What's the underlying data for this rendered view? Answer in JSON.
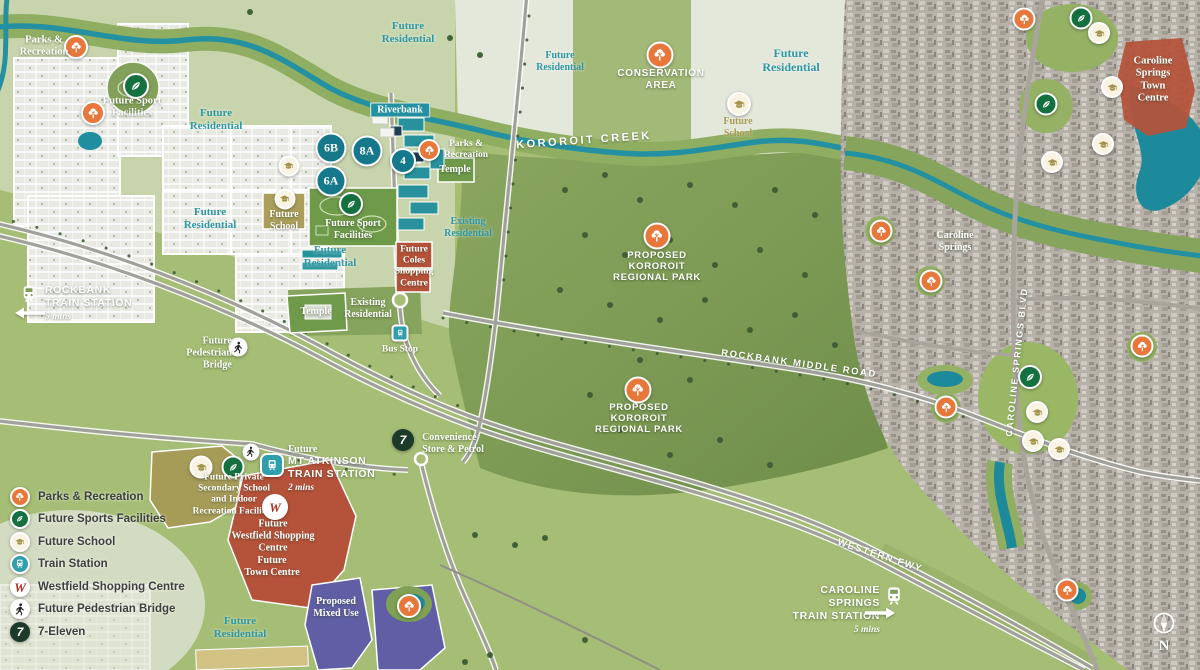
{
  "legend": {
    "items": [
      {
        "icon": "tree-icon",
        "label": "Parks & Recreation"
      },
      {
        "icon": "leaf-icon",
        "label": "Future Sports Facilities"
      },
      {
        "icon": "school-icon",
        "label": "Future School"
      },
      {
        "icon": "train-icon",
        "label": "Train Station"
      },
      {
        "icon": "westfield-icon",
        "label": "Westfield Shopping Centre"
      },
      {
        "icon": "pedestrian-icon",
        "label": "Future Pedestrian Bridge"
      },
      {
        "icon": "seven-eleven-icon",
        "label": "7-Eleven"
      }
    ]
  },
  "labels": {
    "future_residential": "Future\nResidential",
    "existing_residential": "Existing\nResidential",
    "parks_recreation": "Parks &\nRecreation",
    "future_sport_facilities": "Future Sport\nFacilities",
    "riverbank": "Riverbank",
    "temple": "Temple",
    "future_school": "Future\nSchool",
    "future_coles": "Future\nColes\nShopping\nCentre",
    "bus_stop": "Bus Stop",
    "future_pedestrian_bridge": "Future\nPedestrian\nBridge",
    "conservation_area": "CONSERVATION\nAREA",
    "kororoit_creek": "KOROROIT CREEK",
    "proposed_kororoit_regional_park": "PROPOSED\nKOROROIT\nREGIONAL PARK",
    "rockbank_middle_road": "ROCKBANK MIDDLE ROAD",
    "western_fwy": "WESTERN FWY",
    "caroline_springs_blvd": "CAROLINE SPRINGS BLVD",
    "caroline_springs": "Caroline\nSprings",
    "caroline_springs_town_centre": "Caroline\nSprings Town\nCentre",
    "proposed_mixed_use": "Proposed\nMixed Use",
    "future_town_centre": "Future\nTown Centre",
    "future_westfield_shopping_centre": "Future\nWestfield Shopping\nCentre",
    "future_private_school": "Future Private\nSecondary School\nand Indoor\nRecreation Facilities",
    "convenience_store_petrol": "Convenience\nStore & Petrol",
    "north": "N",
    "westfield_w": "W",
    "seven": "7"
  },
  "stations": {
    "rockbank": {
      "name": "ROCKBANK\nTRAIN STATION",
      "time": "5 mins"
    },
    "mt_atkinson": {
      "prefix": "Future",
      "name": "MT ATKINSON\nTRAIN STATION",
      "time": "2 mins"
    },
    "caroline_springs": {
      "name": "CAROLINE SPRINGS\nTRAIN STATION",
      "time": "5 mins"
    }
  },
  "estate_badges": [
    "6B",
    "8A",
    "6A",
    "4"
  ],
  "colors": {
    "base_green": "#a5bd74",
    "park_green": "#7d9b54",
    "creek_teal": "#2391a2",
    "residential_grey": "#e7e9e2",
    "red_centre": "#b5523a",
    "purple_mixed_use": "#605fa5",
    "olive_school": "#a79b58",
    "teal_buildings": "#27929b",
    "teal_text": "#2f97a4",
    "icon_orange": "#e8773b",
    "icon_green": "#15703f",
    "icon_olive": "#a3934d",
    "icon_train_teal": "#2f9fae"
  }
}
